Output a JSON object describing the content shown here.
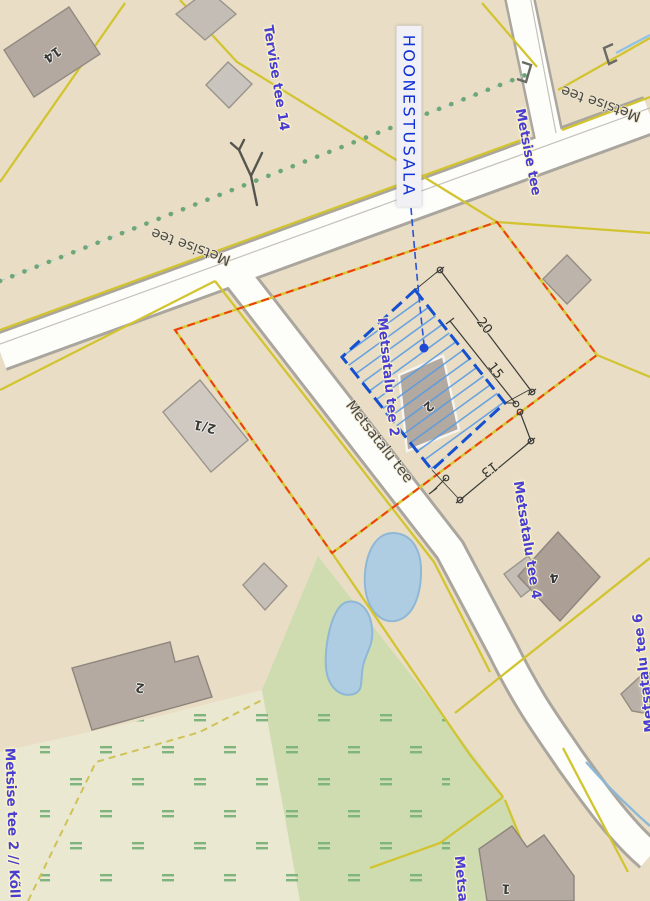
{
  "annotation": {
    "hoonestusala_label": "HOONESTUSALA",
    "dimensions": [
      {
        "value": "20"
      },
      {
        "value": "15"
      },
      {
        "value": "13"
      }
    ]
  },
  "roads": {
    "labels": [
      {
        "text": "Metsise tee"
      },
      {
        "text": "Metsise tee"
      },
      {
        "text": "Metsatalu tee"
      }
    ]
  },
  "addresses": {
    "labels": [
      {
        "text": "Tervise tee 14"
      },
      {
        "text": "Metsise tee"
      },
      {
        "text": "Metsatalu tee 2"
      },
      {
        "text": "Metsatalu tee 4"
      },
      {
        "text": "Metsatalu tee 6"
      },
      {
        "text": "Metsise tee 2 // Kõll"
      },
      {
        "text": "Metsat"
      }
    ]
  },
  "buildings": {
    "numbers": [
      {
        "value": "14"
      },
      {
        "value": "2/1"
      },
      {
        "value": "2"
      },
      {
        "value": "2"
      },
      {
        "value": "4"
      },
      {
        "value": "1"
      }
    ]
  },
  "colors": {
    "plan_blue": "#1450cf",
    "boundary_red": "#f03c14",
    "parcel_yellow": "#d2c431",
    "label_blue": "#4a3ed2",
    "water": "#aecde3",
    "green_area": "#cedcb0"
  }
}
